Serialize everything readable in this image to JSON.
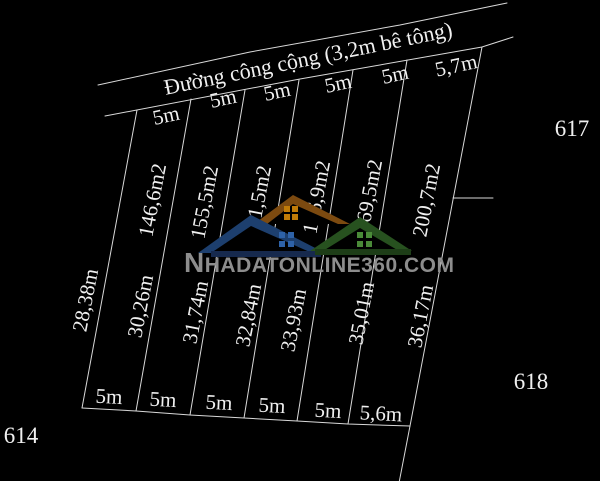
{
  "diagram": {
    "road_label": "Đường công cộng (3,2m bê tông)",
    "top_widths": [
      "5m",
      "5m",
      "5m",
      "5m",
      "5m",
      "5,7m"
    ],
    "bottom_widths": [
      "5m",
      "5m",
      "5m",
      "5m",
      "5m",
      "5,6m"
    ],
    "areas": [
      "146,6m2",
      "155,5m2",
      "161,5m2",
      "166,9m2",
      "169,5m2",
      "200,7m2"
    ],
    "side_lengths": [
      "28,38m",
      "30,26m",
      "31,74m",
      "32,84m",
      "33,93m",
      "35,01m",
      "36,17m"
    ],
    "neighbor_parcels": {
      "top_right": "617",
      "right": "618",
      "bottom_left": "614"
    }
  },
  "watermark": {
    "initial": "N",
    "rest": "HADATONLINE360.COM"
  },
  "colors": {
    "background": "#000000",
    "line": "#d9d9d9",
    "label_text": "#f0f0f0",
    "watermark_text": "#8d8d8d",
    "roof_blue": "#1d3f6e",
    "roof_brown": "#7c4a10",
    "roof_green": "#27511f",
    "base_navy": "#16294d",
    "base_green": "#1d3d17",
    "window_blue": "#2e62a8",
    "window_orange": "#c07b08",
    "window_green": "#4a8a38",
    "cutout": "#000000"
  }
}
